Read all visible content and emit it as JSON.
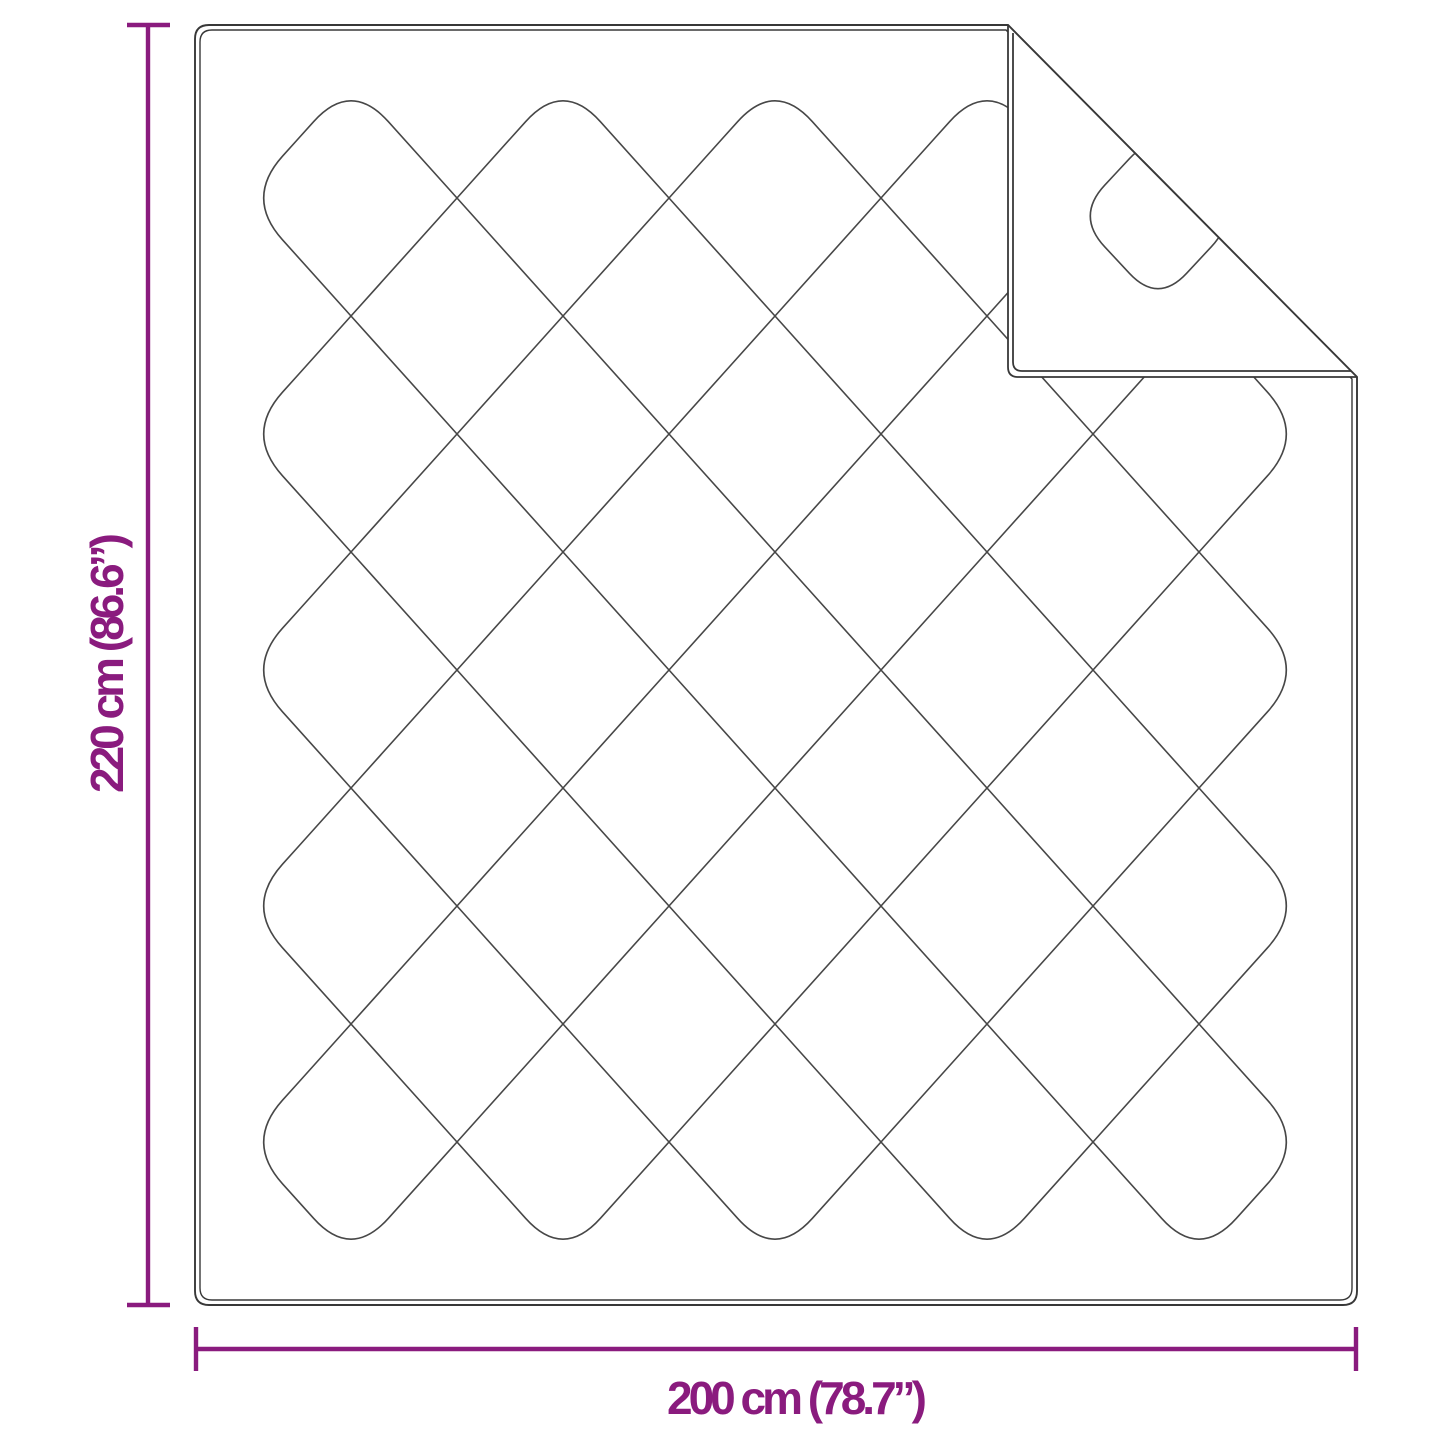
{
  "diagram": {
    "height_label": "220 cm (86.6”)",
    "width_label": "200 cm (78.7”)",
    "colors": {
      "dimension": "#8A1B7E",
      "outline": "#383838",
      "quilt_line": "#474747",
      "background": "#FFFFFF"
    }
  }
}
